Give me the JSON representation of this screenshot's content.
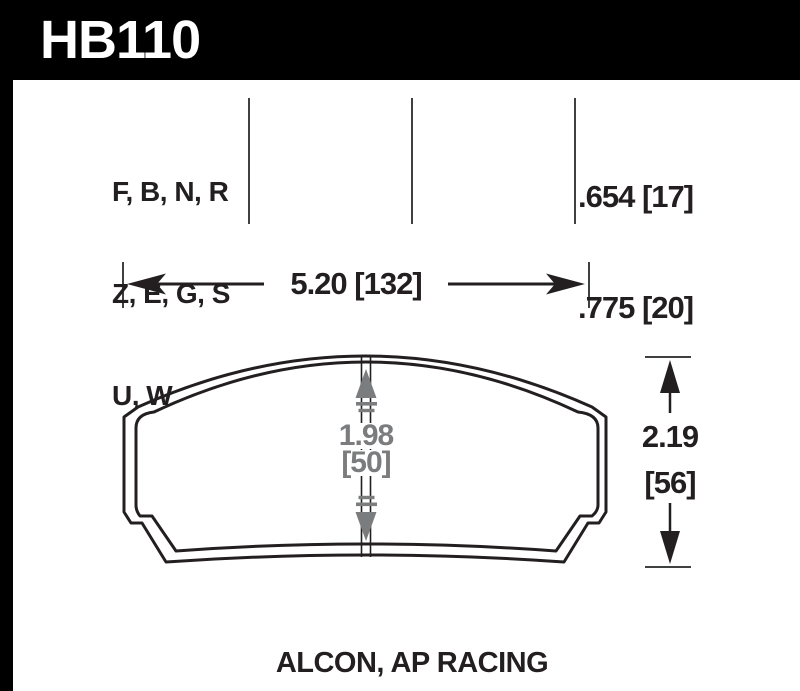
{
  "title": {
    "part_number": "HB110"
  },
  "spec_table": {
    "compound_rows": [
      "F, B, N, R",
      "Z, E, G, S",
      "U, W"
    ],
    "thickness_values": [
      ".654 [17]",
      ".775 [20]"
    ]
  },
  "dimensions": {
    "overall_width": "5.20 [132]",
    "pad_height": {
      "inches": "1.98",
      "millimeters": "[50]"
    },
    "overall_height": {
      "inches": "2.19",
      "millimeters": "[56]"
    }
  },
  "footer": {
    "applications": "ALCON, AP RACING"
  },
  "colors": {
    "ink": "#231f20",
    "dimension_gray": "#7b7c7e",
    "divider_gray": "#3f4042",
    "header_bg": "#000000",
    "header_text": "#ffffff"
  }
}
